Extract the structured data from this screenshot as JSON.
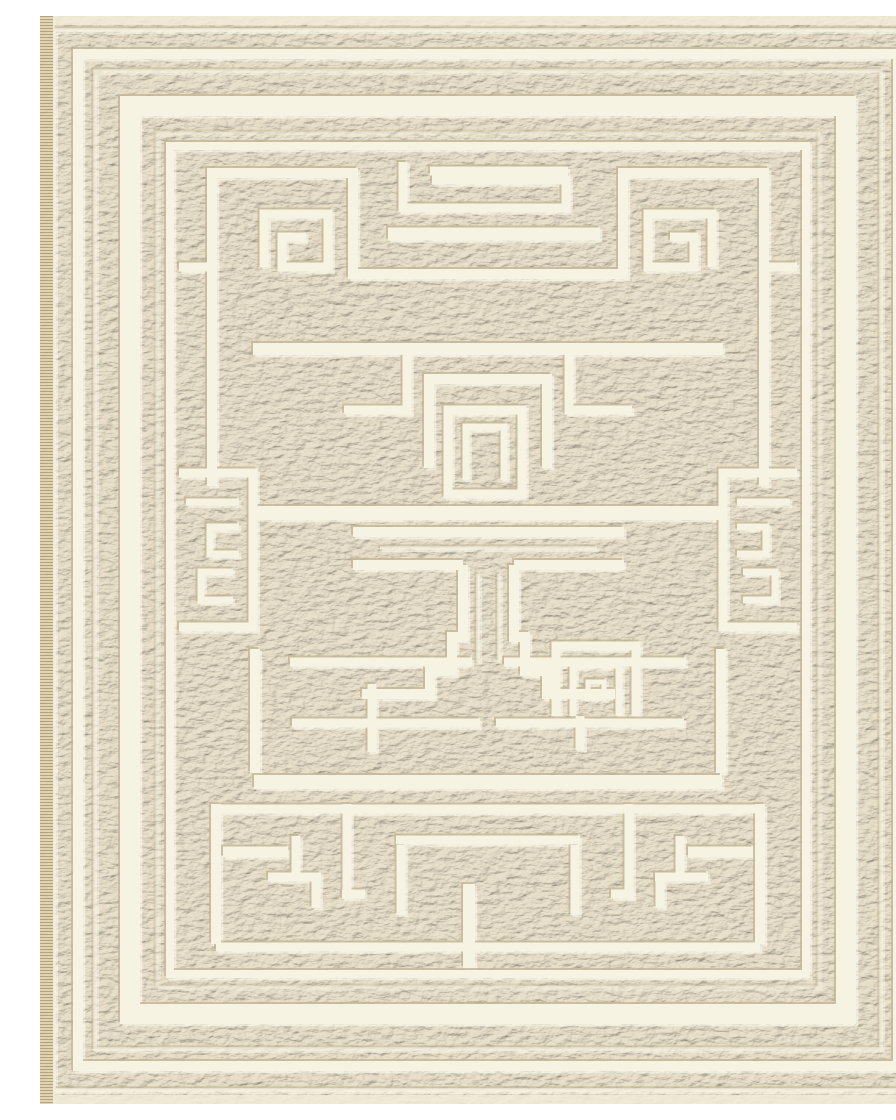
{
  "meta": {
    "subject": "Ivory cream area rug with embossed Greek key labyrinth maze pattern",
    "alt": "Cream-colored woven rug, full-bleed product photo, with raised braided texture and recessed ivory grooves forming concentric border frames, corner spiral keys, a central T-shaped motif, side key medallions and a maze field"
  },
  "colors": {
    "page_background": "#ffffff",
    "rug_base": "#eae2cc",
    "groove_ivory": "#f7f3e2",
    "emboss_shadow": "#c6b795",
    "emboss_highlight": "#fffef5",
    "edge_band": "#f1ebd7",
    "fringe": "#e0d3b2",
    "fringe_line": "#af9e74",
    "vignette": "rgba(120,98,60,0.16)"
  }
}
